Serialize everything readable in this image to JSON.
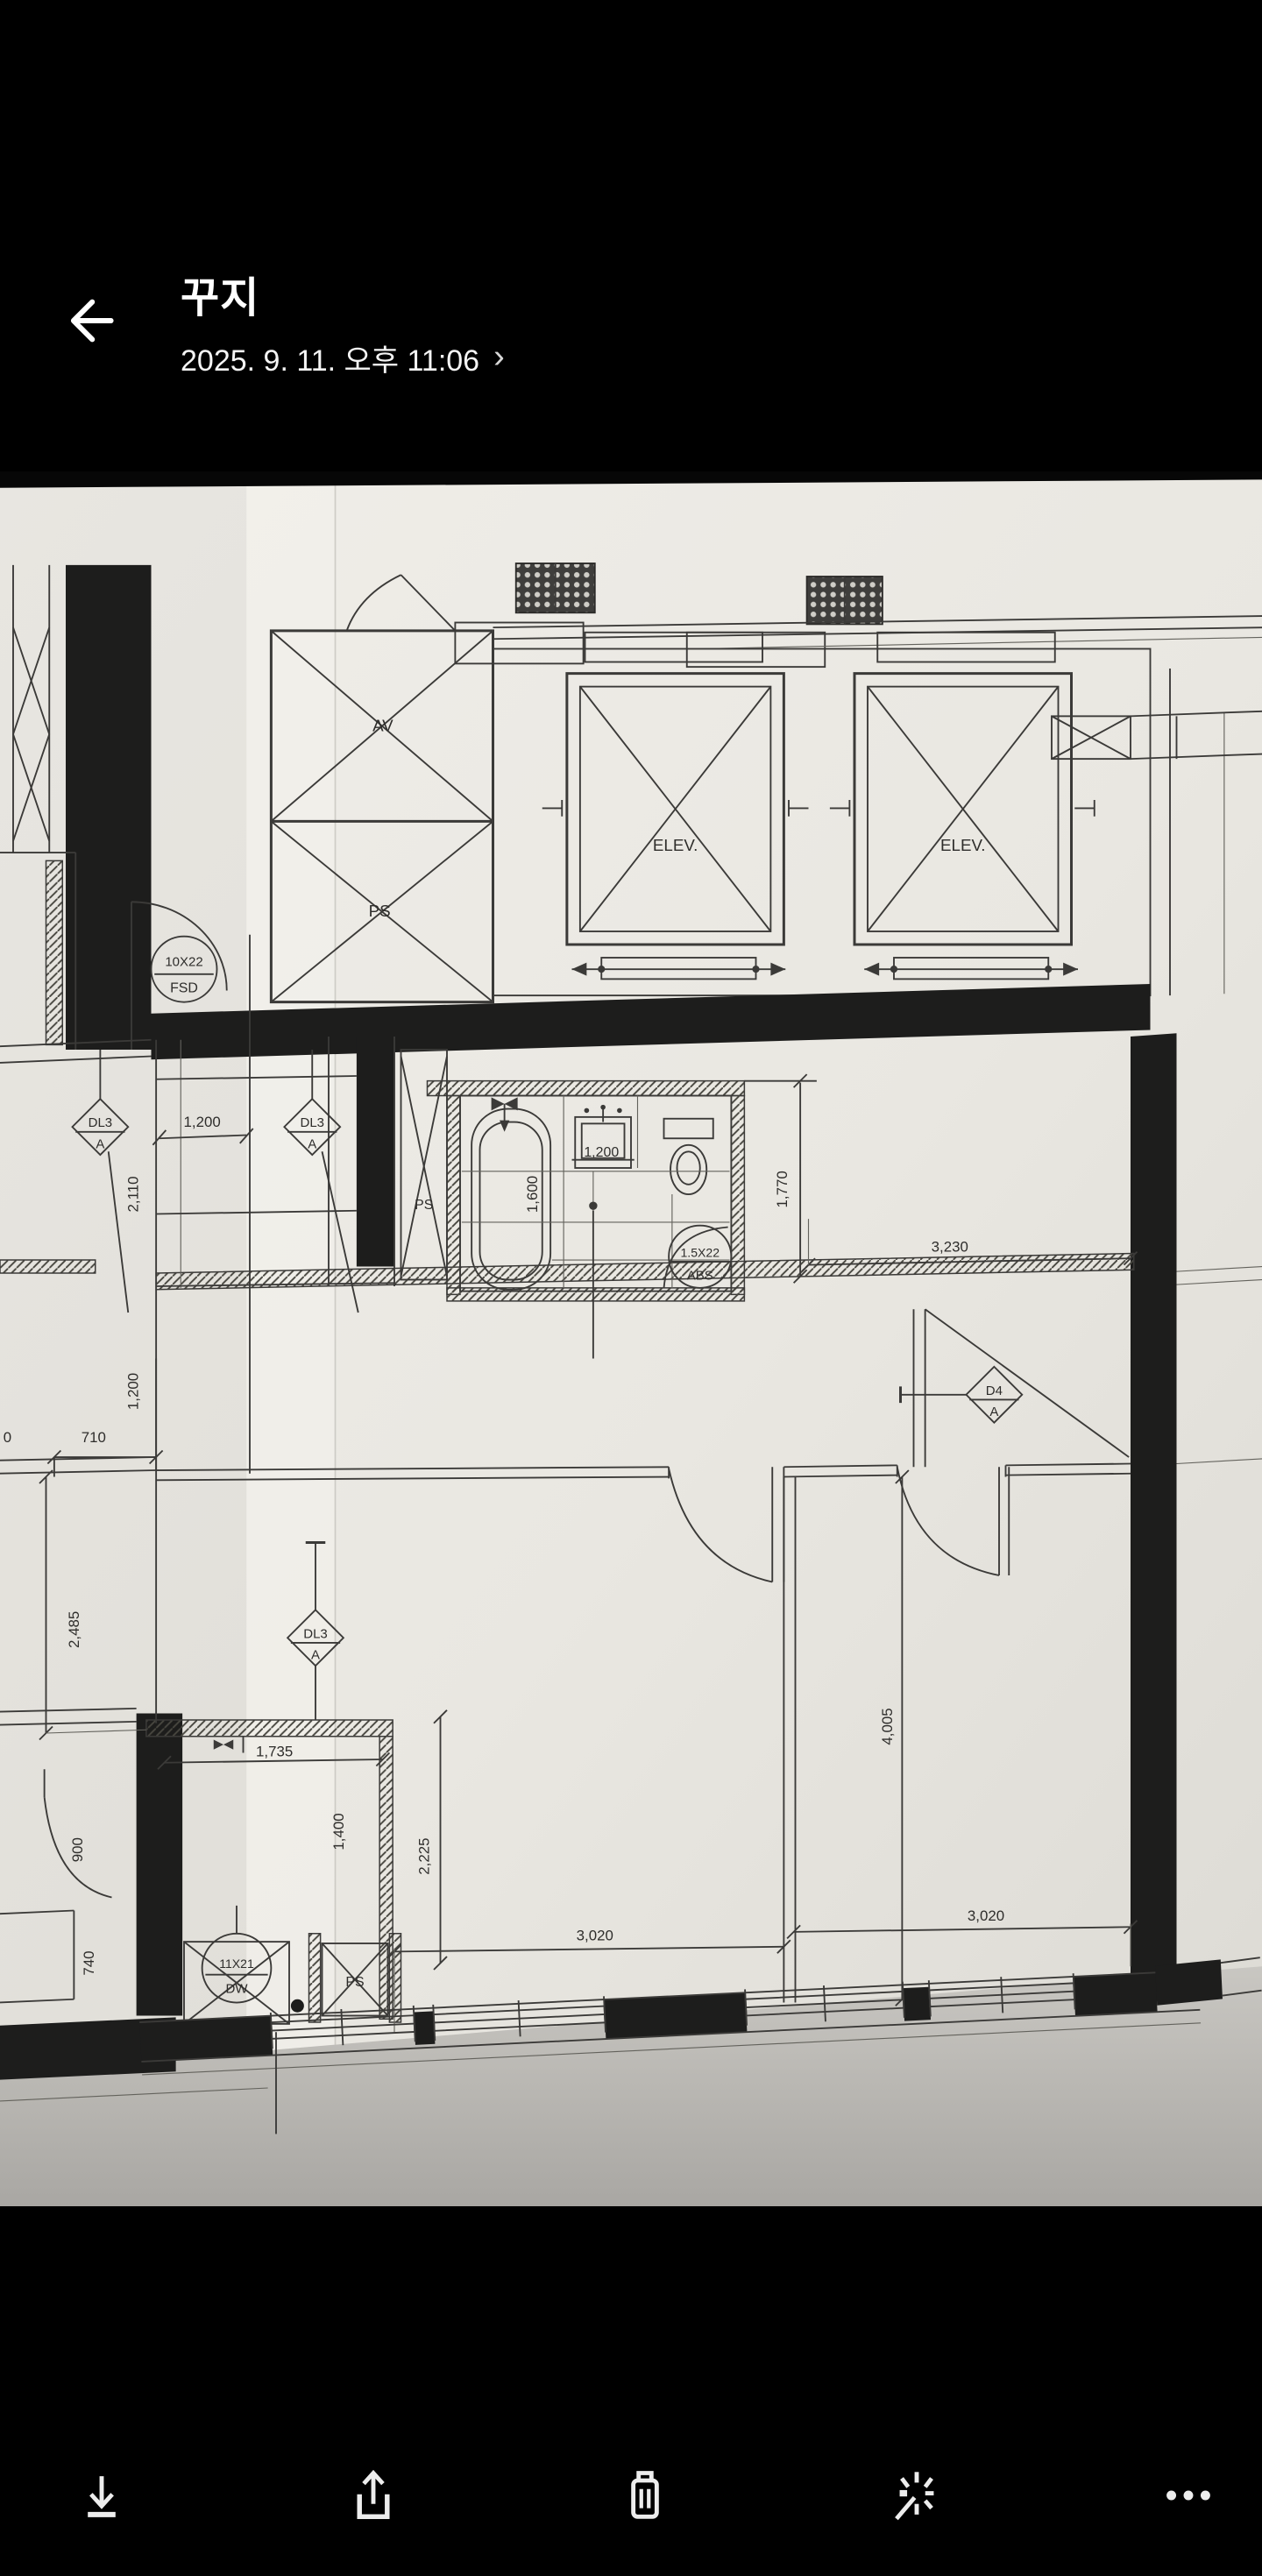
{
  "header": {
    "title": "꾸지",
    "date": "2025. 9. 11. 오후 11:06",
    "chevron": "›",
    "back_icon": "arrow-left"
  },
  "toolbar": {
    "icons": [
      "download-icon",
      "share-icon",
      "trash-icon",
      "ai-sparkle-icon",
      "more-icon"
    ]
  },
  "colors": {
    "app_bg": "#000000",
    "header_text": "#ffffff",
    "icon": "#ededed",
    "paper": "#e9e7e1",
    "ink": "#3b3a38",
    "wall_black": "#1d1d1c",
    "paper_shadow": "#b3b1ac"
  },
  "floorplan": {
    "labels": {
      "elev": "ELEV.",
      "av": "AV",
      "ps": "PS",
      "fsd_top": "10X22",
      "fsd_bot": "FSD",
      "dl3_top": "DL3",
      "dl3_bot": "A",
      "d4_top": "D4",
      "d4_bot": "A",
      "abs_top": "1.5X22",
      "abs_bot": "ABS",
      "dw_top": "11X21",
      "dw_bot": "DW"
    },
    "dims": {
      "w1200a": "1,200",
      "h2110": "2,110",
      "h1200b": "1,200",
      "w710": "710",
      "h2485": "2,485",
      "h900": "900",
      "h740": "740",
      "w1735": "1,735",
      "h1400": "1,400",
      "h2225": "2,225",
      "w3020a": "3,020",
      "w3020b": "3,020",
      "h4005": "4,005",
      "w3230": "3,230",
      "h1770": "1,770",
      "h1600": "1,600",
      "w1200bath": "1,200",
      "partial0": "0"
    }
  }
}
